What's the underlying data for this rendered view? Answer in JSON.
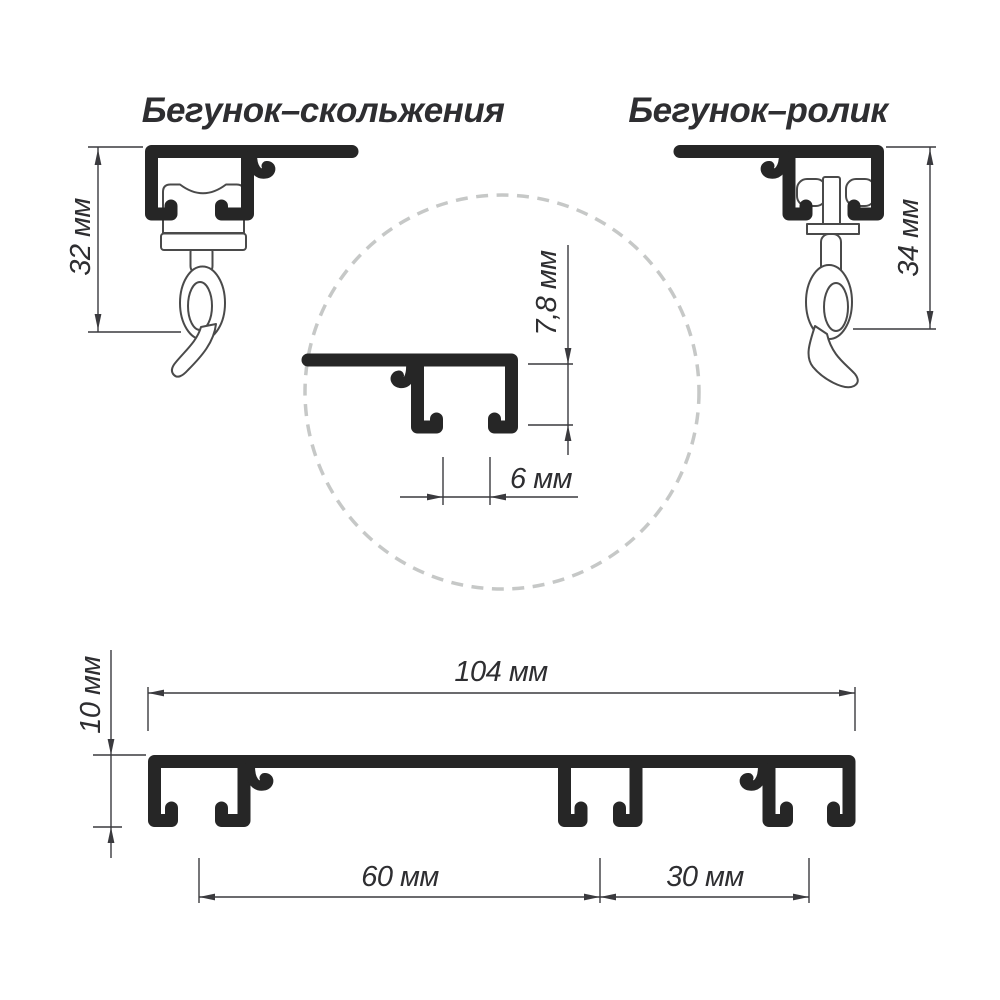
{
  "titles": {
    "slider": "Бегунок–скольжения",
    "roller": "Бегунок–ролик"
  },
  "dimensions": {
    "slider_height": "32 мм",
    "roller_height": "34 мм",
    "groove_depth": "7,8 мм",
    "groove_slot_width": "6 мм",
    "profile_width": "104 мм",
    "profile_height": "10 мм",
    "groove_pitch_wide": "60 мм",
    "groove_pitch_narrow": "30 мм"
  },
  "colors": {
    "background": "#ffffff",
    "profile_fill": "#262626",
    "part_outline": "#4a4a4a",
    "dimension_line": "#3a3a3e",
    "label_text": "#2e2e31",
    "detail_circle": "#c6c8c7"
  }
}
